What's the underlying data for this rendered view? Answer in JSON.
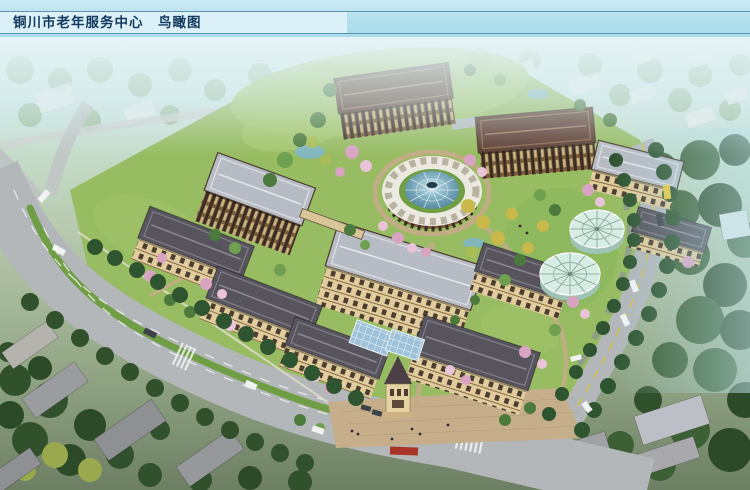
{
  "header": {
    "title": "铜川市老年服务中心　鸟瞰图"
  },
  "palette": {
    "title_strip": "#dcf0f7",
    "title_text": "#123a5e",
    "title_line": "#5e95ae",
    "roof_maroon": "#5d3e33",
    "roof_grey_dark": "#57545d",
    "roof_grey_light": "#b7bbc3",
    "wall_tan": "#e0cc9c",
    "wall_brown": "#7a5a3b",
    "glass_dome": "#3f7089",
    "glass_pavilion": "#d7ece4",
    "road": "#b3b7b9",
    "median_green": "#6f9e45",
    "lawn": "#98bc62",
    "plaza": "#c6ae8b",
    "tree_dark": "#2f5530",
    "tree_mid": "#4c7a3c",
    "blossom_pink": "#d9a3c2",
    "tree_yellow": "#c9b94a",
    "water": "#7fb6c9",
    "sign_red": "#aa3325",
    "bus_yellow": "#e8c73c",
    "car_white": "#f1f3f3"
  }
}
